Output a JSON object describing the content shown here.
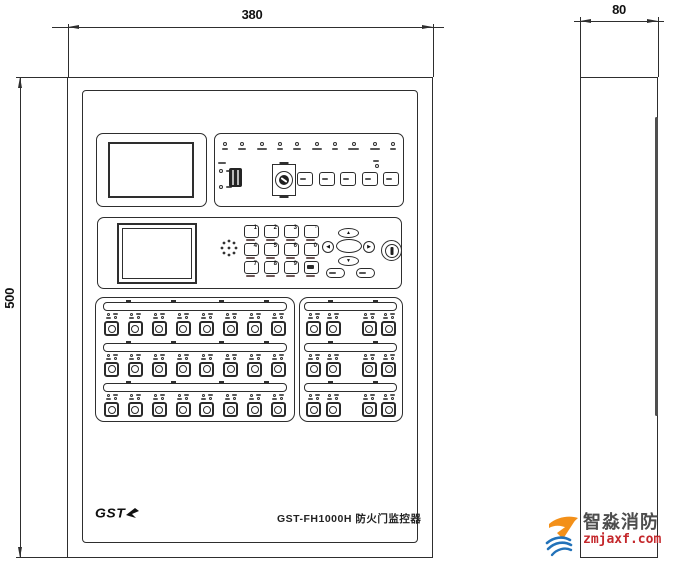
{
  "drawing": {
    "front": {
      "width_label": "380",
      "height_label": "500",
      "brand": "GST",
      "model_label": "GST-FH1000H 防火门监控器",
      "indicator_led_count": 10,
      "aux_led_count": 2,
      "function_button_count": 5,
      "keypad_keys": [
        "1",
        "2",
        "3",
        "·",
        "4",
        "5",
        "6",
        "0",
        "7",
        "8",
        "9",
        ""
      ],
      "nav_arrows": [
        "▲",
        "◀",
        "▶",
        "▼"
      ],
      "switch_panels": {
        "left": {
          "rows": 3,
          "cols": 8
        },
        "right": {
          "rows": 3,
          "cols": 4,
          "gap_after_col": 2
        }
      }
    },
    "side": {
      "depth_label": "80"
    }
  },
  "watermark": {
    "brand": "智淼消防",
    "site": "zmjaxf.com"
  },
  "colors": {
    "line": "#2e2e2e",
    "hinge": "#4f4f4f",
    "wm_brand": "#4d4d4d",
    "wm_site": "#c4272b",
    "wm_orange": "#f39019",
    "wm_blue": "#2272b9"
  }
}
